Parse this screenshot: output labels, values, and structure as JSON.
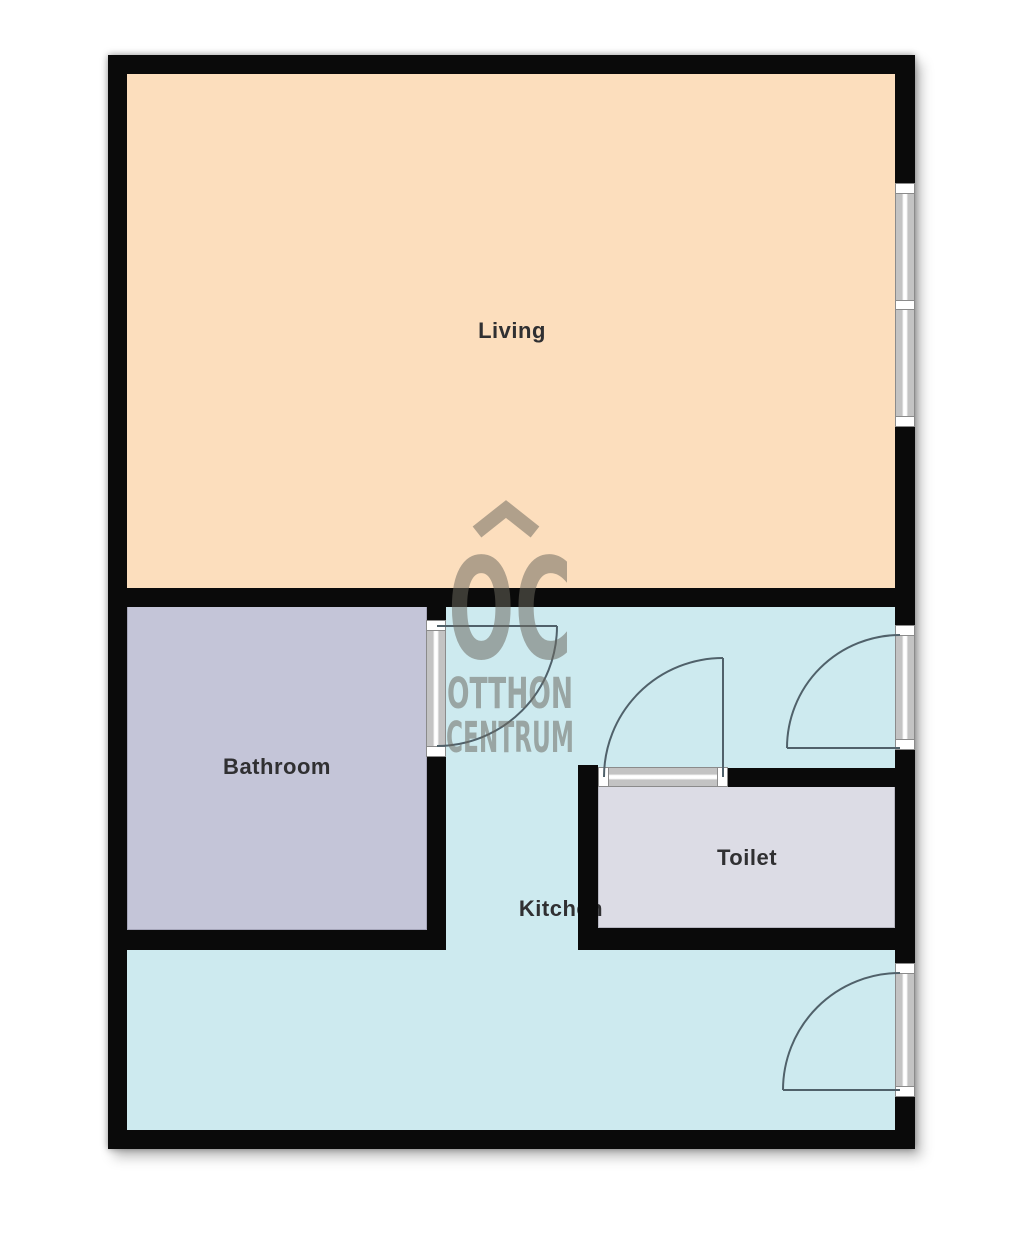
{
  "title": "Apartment floor plan",
  "rooms": {
    "living": {
      "label": "Living",
      "fill": "#FCDEBD"
    },
    "kitchen": {
      "label": "Kitchen",
      "fill": "#CDEAEF"
    },
    "bathroom": {
      "label": "Bathroom",
      "fill": "#C4C5D8"
    },
    "toilet": {
      "label": "Toilet",
      "fill": "#DCDCE5"
    }
  },
  "watermark": {
    "monogram": "OC",
    "line1": "OTTHON",
    "line2": "CENTRUM",
    "color": "#6B685E"
  },
  "palette": {
    "wall": "#0A0A0A",
    "door_swing": "#50616A",
    "opening_fill": "#C3C3C3",
    "background": "#FFFFFF"
  }
}
